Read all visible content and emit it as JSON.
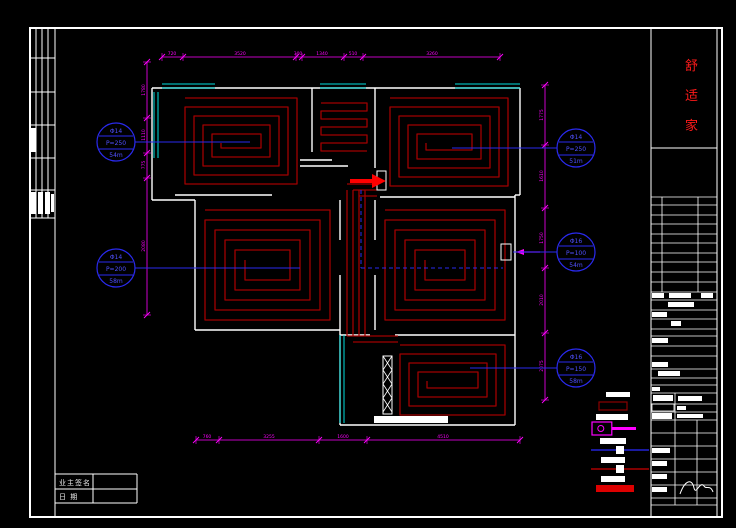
{
  "title_block": {
    "chars": [
      "舒",
      "适",
      "家"
    ],
    "title_color": "#ff1a1a"
  },
  "signature_table": {
    "rows": [
      {
        "label": "业主签名"
      },
      {
        "label": "日    期"
      }
    ]
  },
  "loop_tags": [
    {
      "dia": "Φ14",
      "pitch": "P=250",
      "length": "54m",
      "cx": 116,
      "cy": 142,
      "leader_to": 250
    },
    {
      "dia": "Φ14",
      "pitch": "P=200",
      "length": "58m",
      "cx": 116,
      "cy": 268,
      "leader_to": 300
    },
    {
      "dia": "Φ14",
      "pitch": "P=250",
      "length": "51m",
      "cx": 576,
      "cy": 148,
      "leader_to": 452
    },
    {
      "dia": "Φ16",
      "pitch": "P=100",
      "length": "54m",
      "cx": 576,
      "cy": 252,
      "leader_to": 513
    },
    {
      "dia": "Φ16",
      "pitch": "P=150",
      "length": "58m",
      "cx": 576,
      "cy": 368,
      "leader_to": 470
    }
  ],
  "dimensions": [
    {
      "id": "top",
      "orient": "h",
      "pos": 57,
      "ticks": [
        162,
        183,
        296,
        302,
        344,
        363,
        500
      ],
      "labels": [
        [
          "720",
          172
        ],
        [
          "3520",
          240
        ],
        [
          "300",
          298
        ],
        [
          "1340",
          322
        ],
        [
          "510",
          353
        ],
        [
          "3260",
          432
        ]
      ]
    },
    {
      "id": "bottom",
      "orient": "h",
      "pos": 440,
      "ticks": [
        196,
        219,
        319,
        367,
        520
      ],
      "labels": [
        [
          "760",
          207
        ],
        [
          "3255",
          269
        ],
        [
          "1600",
          343
        ],
        [
          "4510",
          443
        ]
      ]
    },
    {
      "id": "left",
      "orient": "v",
      "pos": 147,
      "ticks": [
        62,
        118,
        153,
        178,
        315
      ],
      "labels": [
        [
          "1780",
          90
        ],
        [
          "1110",
          135
        ],
        [
          "775",
          165
        ],
        [
          "2080",
          246
        ]
      ]
    },
    {
      "id": "right",
      "orient": "v",
      "pos": 545,
      "ticks": [
        85,
        145,
        208,
        268,
        333,
        400
      ],
      "labels": [
        [
          "1775",
          115
        ],
        [
          "1610",
          176
        ],
        [
          "1750",
          238
        ],
        [
          "2010",
          300
        ],
        [
          "2075",
          366
        ]
      ]
    }
  ],
  "plan": {
    "walls": [
      [
        152,
        88,
        520,
        88
      ],
      [
        152,
        88,
        152,
        200
      ],
      [
        152,
        200,
        195,
        200
      ],
      [
        195,
        200,
        195,
        330
      ],
      [
        195,
        330,
        340,
        330
      ],
      [
        340,
        330,
        340,
        425
      ],
      [
        340,
        425,
        515,
        425
      ],
      [
        515,
        425,
        515,
        195
      ],
      [
        520,
        88,
        520,
        195
      ],
      [
        515,
        195,
        520,
        195
      ],
      [
        312,
        88,
        312,
        152
      ],
      [
        375,
        88,
        375,
        168
      ],
      [
        175,
        195,
        272,
        195
      ],
      [
        380,
        197,
        515,
        197
      ],
      [
        340,
        200,
        340,
        240
      ],
      [
        340,
        275,
        340,
        330
      ],
      [
        375,
        200,
        375,
        240
      ],
      [
        375,
        275,
        375,
        330
      ],
      [
        340,
        335,
        370,
        335
      ],
      [
        395,
        335,
        515,
        335
      ],
      [
        300,
        160,
        332,
        160
      ],
      [
        300,
        166,
        348,
        166
      ]
    ],
    "windows": [
      [
        162,
        86,
        215,
        86
      ],
      [
        320,
        86,
        366,
        86
      ],
      [
        455,
        86,
        520,
        86
      ],
      [
        156,
        92,
        156,
        158
      ],
      [
        342,
        335,
        342,
        423
      ]
    ],
    "coils": [
      {
        "type": "spiral",
        "x": 185,
        "y": 98,
        "w": 112,
        "h": 86,
        "gap": 9
      },
      {
        "type": "snake",
        "x": 321,
        "y": 103,
        "w": 46,
        "h": 48,
        "gap": 8
      },
      {
        "type": "spiral",
        "x": 390,
        "y": 98,
        "w": 118,
        "h": 88,
        "gap": 9
      },
      {
        "type": "spiral",
        "x": 205,
        "y": 210,
        "w": 125,
        "h": 110,
        "gap": 10
      },
      {
        "type": "spiral",
        "x": 385,
        "y": 210,
        "w": 120,
        "h": 110,
        "gap": 10
      },
      {
        "type": "spiral",
        "x": 400,
        "y": 345,
        "w": 105,
        "h": 70,
        "gap": 9
      }
    ],
    "pipes": {
      "x0": 347,
      "gap": 6,
      "count": 4,
      "y1": 190,
      "y2": 336,
      "connectors": [
        "M347 336 H398",
        "M353 342 H398",
        "M347 184 H377",
        "M353 190 H377",
        "M359 196 H377"
      ]
    },
    "blue_dashed": [
      [
        361,
        190,
        361,
        268
      ],
      [
        361,
        268,
        503,
        268
      ]
    ],
    "manifold_box": [
      377,
      171,
      9,
      19
    ],
    "inlet_box": [
      501,
      244,
      10,
      16
    ],
    "supply_arrow": {
      "line": [
        350,
        181,
        372,
        181
      ],
      "head": [
        [
          372,
          174
        ],
        [
          386,
          181
        ],
        [
          372,
          188
        ]
      ]
    },
    "magenta_arrow": {
      "line": [
        516,
        252,
        540,
        252
      ],
      "head": [
        [
          516,
          252
        ],
        [
          524,
          249
        ],
        [
          524,
          255
        ]
      ]
    },
    "hatch_column": {
      "rect": [
        383,
        356,
        9,
        58
      ],
      "base": [
        374,
        416,
        74,
        7
      ]
    }
  },
  "legend": {
    "rows": [
      {
        "type": "block",
        "x": 606,
        "y": 392,
        "w": 24,
        "h": 5
      },
      {
        "type": "outlined",
        "x": 599,
        "y": 402,
        "w": 28,
        "h": 8,
        "color": "#8b0000"
      },
      {
        "type": "block",
        "x": 596,
        "y": 414,
        "w": 32,
        "h": 6
      },
      {
        "type": "manifold",
        "x": 592,
        "y": 422,
        "w": 44,
        "h": 13,
        "color": "#ff00ff"
      },
      {
        "type": "block",
        "x": 600,
        "y": 438,
        "w": 26,
        "h": 6
      },
      {
        "type": "hline",
        "y": 450,
        "x1": 591,
        "x2": 649,
        "color": "#2a2aff",
        "sq": [
          616,
          446,
          8,
          8
        ]
      },
      {
        "type": "block",
        "x": 601,
        "y": 457,
        "w": 24,
        "h": 6
      },
      {
        "type": "hline",
        "y": 469,
        "x1": 591,
        "x2": 649,
        "color": "#cc0000",
        "sq": [
          616,
          465,
          8,
          8
        ]
      },
      {
        "type": "block",
        "x": 601,
        "y": 476,
        "w": 24,
        "h": 6
      },
      {
        "type": "solidbar",
        "x": 596,
        "y": 485,
        "w": 38,
        "h": 7,
        "color": "#dd0000"
      }
    ]
  },
  "left_strip": {
    "v_lines": [
      30,
      36,
      42,
      48,
      55
    ],
    "h_lines": [
      28,
      58,
      92,
      125,
      158,
      190,
      218
    ],
    "fills": [
      [
        31,
        128,
        5,
        24
      ],
      [
        31,
        192,
        5,
        22
      ],
      [
        38,
        192,
        5,
        22
      ],
      [
        45,
        192,
        5,
        22
      ],
      [
        51,
        194,
        3,
        18
      ]
    ]
  },
  "right_panel": {
    "h_lines": [
      197,
      205,
      215,
      224,
      234,
      243,
      253,
      262,
      272,
      282,
      292,
      300,
      310,
      319,
      329,
      336,
      346,
      356,
      369,
      378,
      385,
      393,
      404,
      412,
      420,
      433,
      446,
      459,
      472,
      485,
      498,
      505
    ],
    "v_segs": [
      [
        662,
        197,
        292
      ],
      [
        698,
        197,
        292
      ],
      [
        675,
        393,
        505
      ],
      [
        697,
        420,
        505
      ]
    ],
    "fills": [
      [
        652,
        293,
        12,
        5
      ],
      [
        669,
        293,
        22,
        5
      ],
      [
        701,
        293,
        12,
        5
      ],
      [
        668,
        302,
        26,
        5
      ],
      [
        652,
        312,
        15,
        5
      ],
      [
        671,
        321,
        10,
        5
      ],
      [
        652,
        338,
        16,
        5
      ],
      [
        652,
        362,
        16,
        5
      ],
      [
        658,
        371,
        22,
        5
      ],
      [
        652,
        387,
        8,
        4
      ],
      [
        653,
        395,
        20,
        6
      ],
      [
        678,
        396,
        24,
        5
      ],
      [
        677,
        406,
        9,
        4
      ],
      [
        652,
        413,
        20,
        6
      ],
      [
        677,
        414,
        26,
        4
      ],
      [
        652,
        448,
        18,
        5
      ],
      [
        652,
        461,
        15,
        5
      ],
      [
        652,
        474,
        15,
        5
      ],
      [
        652,
        487,
        15,
        5
      ]
    ],
    "outlines": [
      [
        652,
        404,
        22,
        7
      ]
    ],
    "squiggle": "M680,494 C685,480 692,478 694,488 C696,496 700,480 704,486 C706,490 710,484 713,492"
  },
  "colors": {
    "wall": "#ffffff",
    "coil": "#a00000",
    "hot": "#ff0000",
    "window": "#00e0e0",
    "dim": "#ff00ff",
    "tag": "#2a2aee",
    "tag_text": "#5050ff",
    "title": "#ff1a1a"
  }
}
